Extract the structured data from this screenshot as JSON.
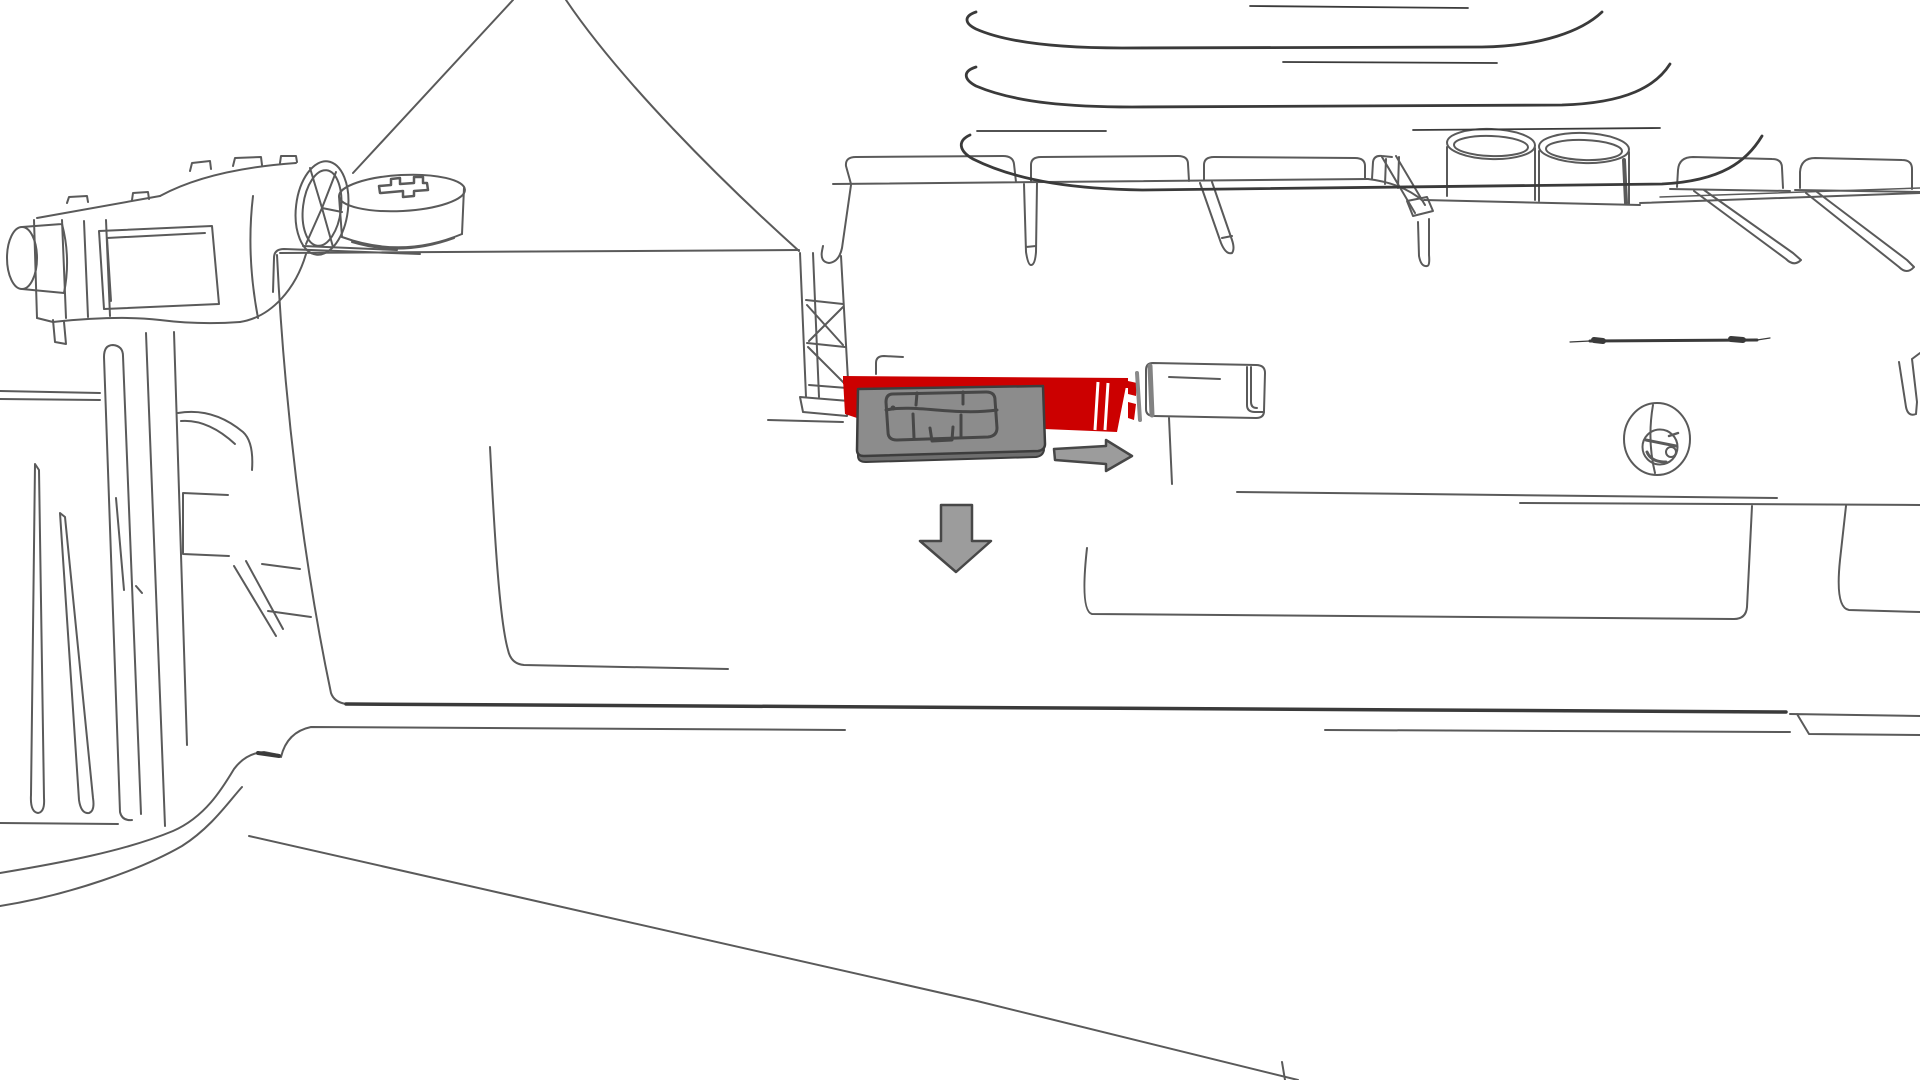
{
  "page": {
    "background": "#ffffff"
  },
  "illustration": {
    "kind": "technical-line-art-instruction",
    "subject": "insert-sim-card-into-device-sim-slot",
    "line_color": "#5a5a5a",
    "dark_line_color": "#3a3a3a",
    "highlight_color": "#cc0000",
    "sim_card": {
      "body_fill": "#8c8c8c",
      "side_fill": "#6e6e6e",
      "outline_color": "#3d3d3d",
      "chip_line_color": "#474747"
    },
    "latch": {
      "face_fill": "#ffffff",
      "edge_shade": "#828282",
      "gap_shade": "#8a8a8a"
    },
    "arrows": {
      "fill": "#9c9c9c",
      "outline": "#474747",
      "items": [
        {
          "direction": "right"
        },
        {
          "direction": "down"
        }
      ]
    },
    "parts": [
      "top-lid-edges",
      "carriage-assembly",
      "drum-roller",
      "screw-boss",
      "base-platform",
      "main-panel",
      "sim-bracket",
      "comb-rail",
      "cylindrical-posts",
      "right-comb-rail",
      "right-panel",
      "panel-screw",
      "panel-slot-line",
      "left-structures",
      "chassis-edges",
      "cable-loops",
      "sim-slot-highlight",
      "sim-card",
      "sim-chip-contacts",
      "latch-block",
      "arrow-right",
      "arrow-down"
    ]
  }
}
